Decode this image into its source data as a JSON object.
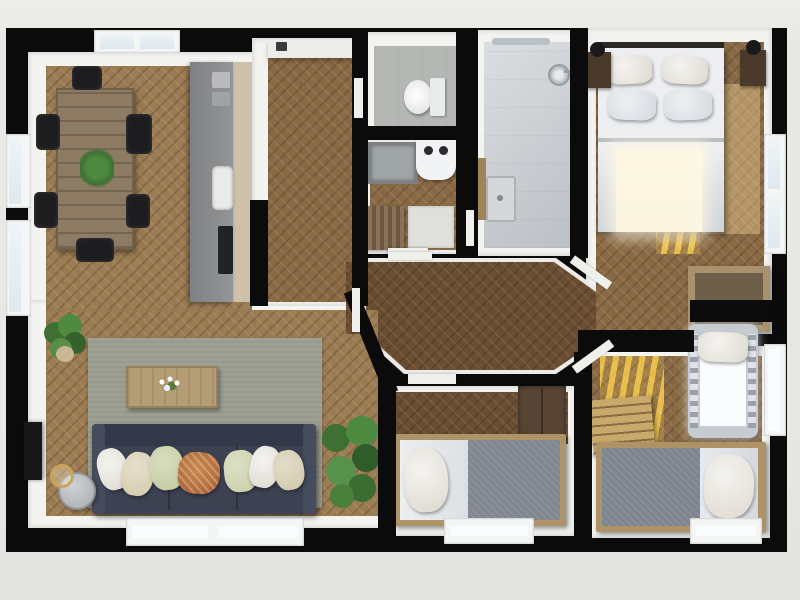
{
  "scene": {
    "type": "3d-floorplan-top-down-render",
    "description": "Photorealistic top-down 3D floor plan of an apartment with open living-dining-kitchen, entry hall, WC, laundry, bathroom, master bedroom, central angled hallway, two further bedrooms with crib and staircase",
    "background_color": "#e7e7e3",
    "wall_color": "#0b0b0b",
    "wall_face_color": "#f3f3f0"
  },
  "rooms": [
    {
      "id": "living-dining-kitchen",
      "floor": "light-herringbone-oak",
      "furniture": [
        "rustic-dining-table",
        "dining-chairs-x6",
        "table-plant",
        "kitchen-counter",
        "kitchen-sink",
        "cooktop",
        "small-appliances",
        "area-rug",
        "coffee-table",
        "flower-vase",
        "dark-blue-sofa",
        "throw-pillows-x7",
        "round-side-table",
        "gold-floor-lamp",
        "wall-tv",
        "monstera-plant",
        "potted-plant"
      ]
    },
    {
      "id": "entry-hall",
      "floor": "herringbone-oak",
      "furniture": [
        "wall-hook"
      ]
    },
    {
      "id": "wc",
      "floor": "gray-tile",
      "furniture": [
        "toilet"
      ]
    },
    {
      "id": "laundry-room",
      "floor": "herringbone-oak",
      "furniture": [
        "washing-machine",
        "storage-bin",
        "wooden-drying-rack",
        "floor-mat"
      ]
    },
    {
      "id": "bathroom",
      "floor": "blue-gray-tile",
      "furniture": [
        "walk-in-shower",
        "shower-head",
        "wash-basin",
        "wooden-vanity",
        "ceiling-vent"
      ]
    },
    {
      "id": "master-bedroom",
      "floor": "herringbone-oak",
      "furniture": [
        "double-bed",
        "pillows-x4",
        "nightstand-left",
        "nightstand-right",
        "bedside-lamp-left",
        "bedside-lamp-right",
        "storage-chest"
      ]
    },
    {
      "id": "hallway",
      "floor": "dark-herringbone-oak",
      "furniture": []
    },
    {
      "id": "bedroom-2",
      "floor": "dark-herringbone-oak",
      "furniture": [
        "single-bed",
        "white-pillow",
        "gray-blanket",
        "dark-wardrobe"
      ]
    },
    {
      "id": "bedroom-3",
      "floor": "herringbone-oak",
      "furniture": [
        "single-bed",
        "white-pillow",
        "gray-blanket",
        "baby-crib",
        "staircase",
        "sunlight-stripes"
      ]
    }
  ],
  "windows": [
    {
      "id": "skylight-dining",
      "wall": "top"
    },
    {
      "id": "window-left-1",
      "wall": "left"
    },
    {
      "id": "window-left-2",
      "wall": "left"
    },
    {
      "id": "window-living-bottom",
      "wall": "bottom"
    },
    {
      "id": "window-bedroom2-bottom",
      "wall": "bottom"
    },
    {
      "id": "window-bedroom3-bottom",
      "wall": "bottom"
    },
    {
      "id": "window-master-right",
      "wall": "right"
    },
    {
      "id": "window-crib-right",
      "wall": "right"
    }
  ],
  "palette": {
    "floor_light": "#9c7c52",
    "floor_mid": "#8a6a44",
    "floor_dark": "#6b4e31",
    "rug": "#9da093",
    "sofa": "#3c4252",
    "bed_linen": "#e8eaec",
    "blanket_gray": "#81878f",
    "bed_frame_wood": "#ad9365",
    "wardrobe_brown": "#584434",
    "sunlight": "#ffd987",
    "plant_green": "#3e7034",
    "gold_accent": "#c9a45c"
  }
}
